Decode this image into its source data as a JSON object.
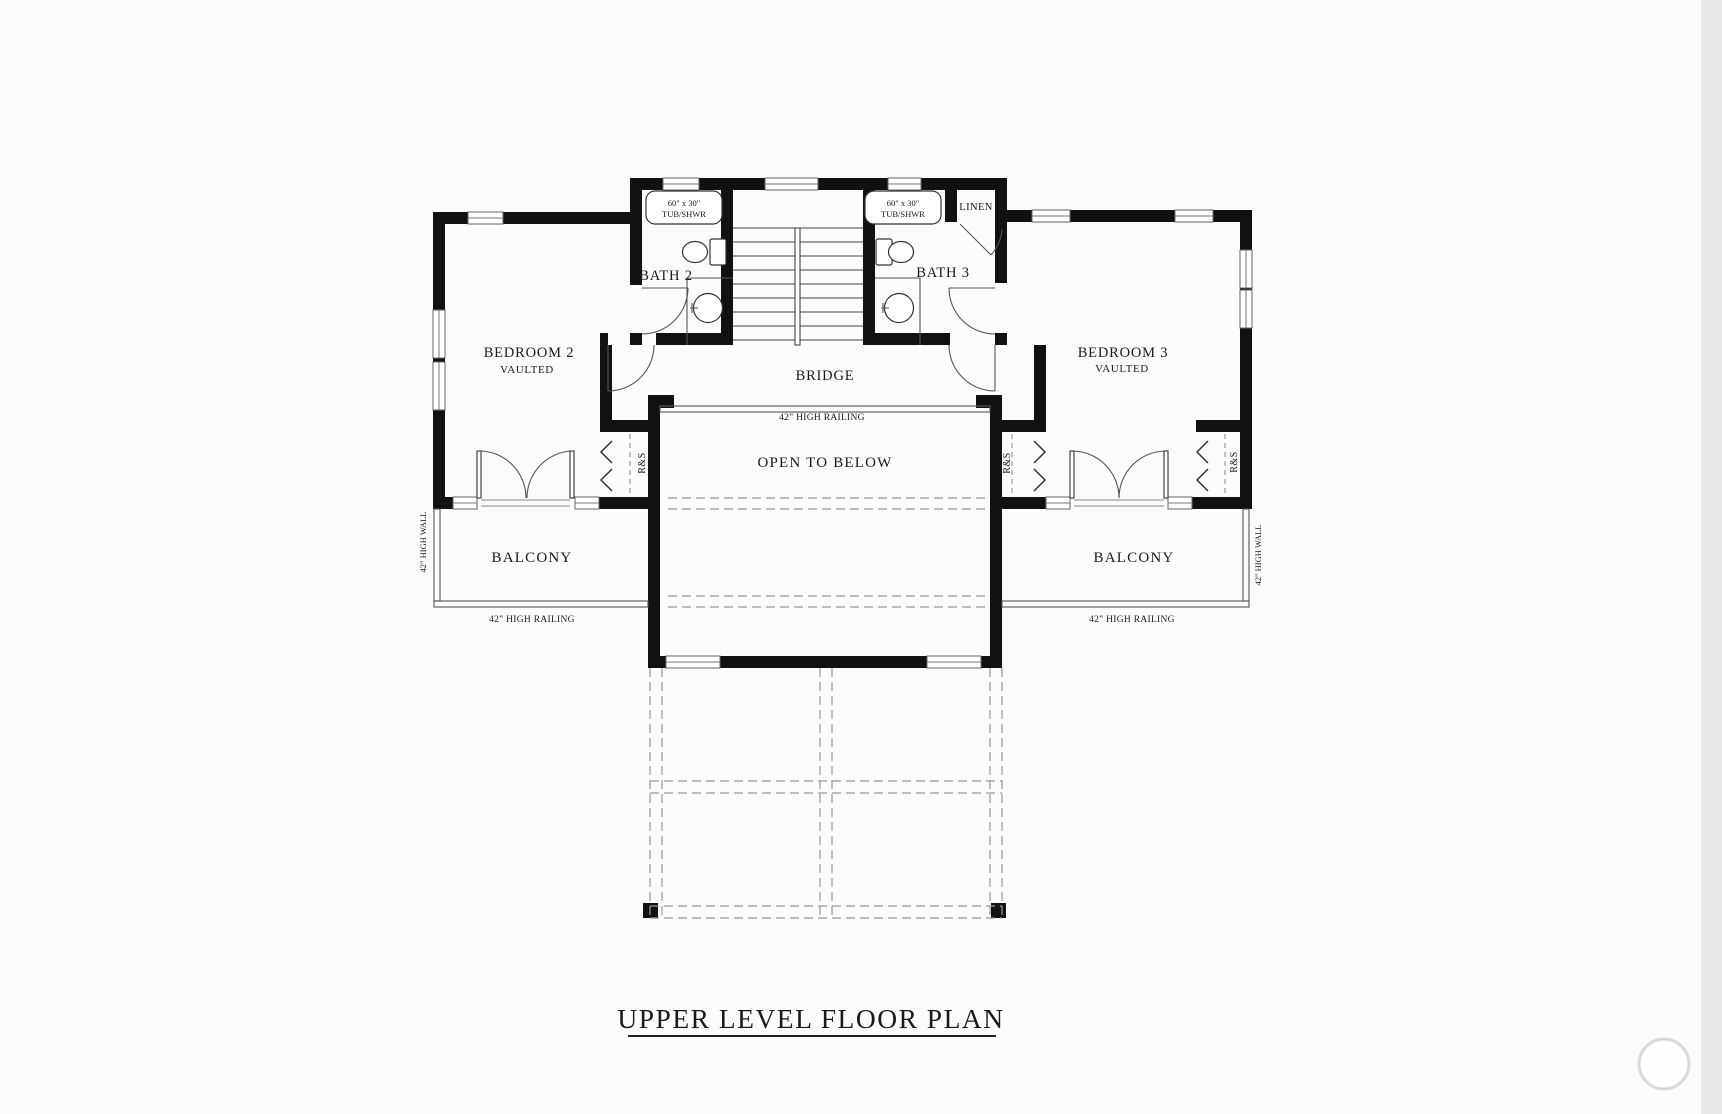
{
  "title": "UPPER LEVEL FLOOR PLAN",
  "rooms": {
    "bedroom2": {
      "name": "BEDROOM 2",
      "note": "VAULTED"
    },
    "bedroom3": {
      "name": "BEDROOM 3",
      "note": "VAULTED"
    },
    "bath2": {
      "name": "BATH 2"
    },
    "bath3": {
      "name": "BATH 3"
    },
    "linen": {
      "name": "LINEN"
    },
    "bridge": {
      "name": "BRIDGE"
    },
    "open_to_below": {
      "name": "OPEN TO BELOW"
    },
    "balcony_left": {
      "name": "BALCONY"
    },
    "balcony_right": {
      "name": "BALCONY"
    }
  },
  "fixtures": {
    "tub_label_line1": "60\" x 30\"",
    "tub_label_line2": "TUB/SHWR",
    "closet_label": "R&S"
  },
  "annotations": {
    "railing_bridge": "42\" HIGH RAILING",
    "railing_balcony_left": "42\" HIGH RAILING",
    "railing_balcony_right": "42\" HIGH RAILING",
    "high_wall_left": "42\" HIGH WALL",
    "high_wall_right": "42\" HIGH WALL"
  },
  "colors": {
    "wall": "#111111",
    "dashed_outline": "#9a9a9a",
    "paper": "#fbfbfa"
  }
}
